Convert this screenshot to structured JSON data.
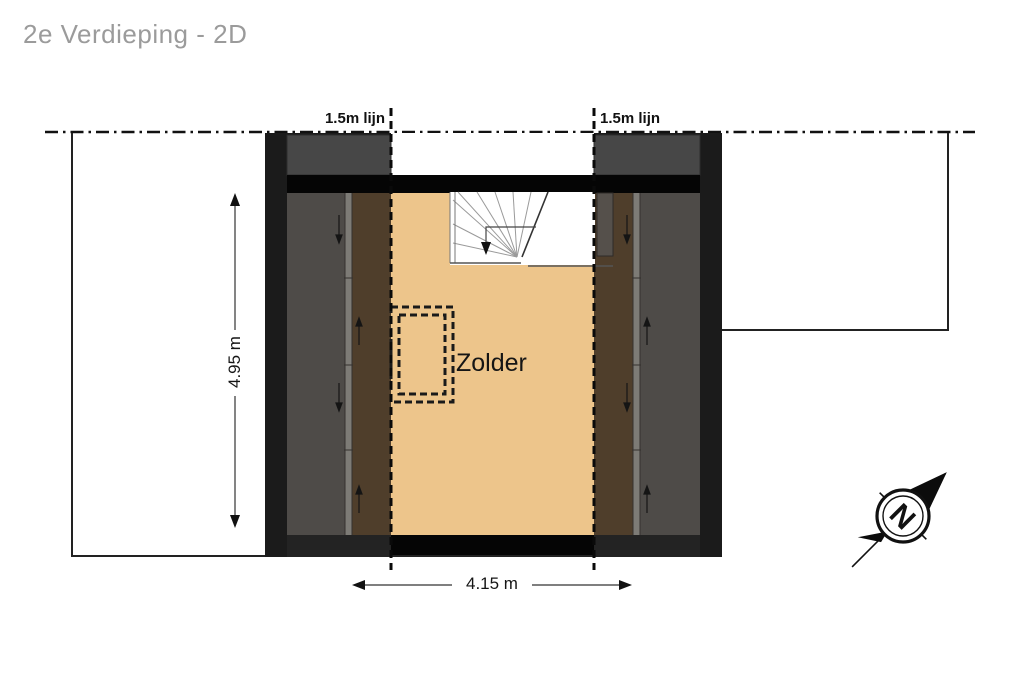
{
  "title": "2e Verdieping - 2D",
  "floor_plan": {
    "room_label": "Zolder",
    "height_line_left_label": "1.5m lijn",
    "height_line_right_label": "1.5m lijn",
    "dimension_height": "4.95 m",
    "dimension_width": "4.15 m",
    "compass_north_label": "N"
  },
  "colors": {
    "floor": "#edc58b",
    "wall": "#1b1b1b",
    "band": "#050505",
    "roof_gray": "#474747",
    "side_gray": "#4e4b48",
    "eaves_brown": "#4f3e2b",
    "window_strip": "#7d7b76",
    "title_text": "#9b9b9b",
    "ink": "#1a1a1a"
  }
}
